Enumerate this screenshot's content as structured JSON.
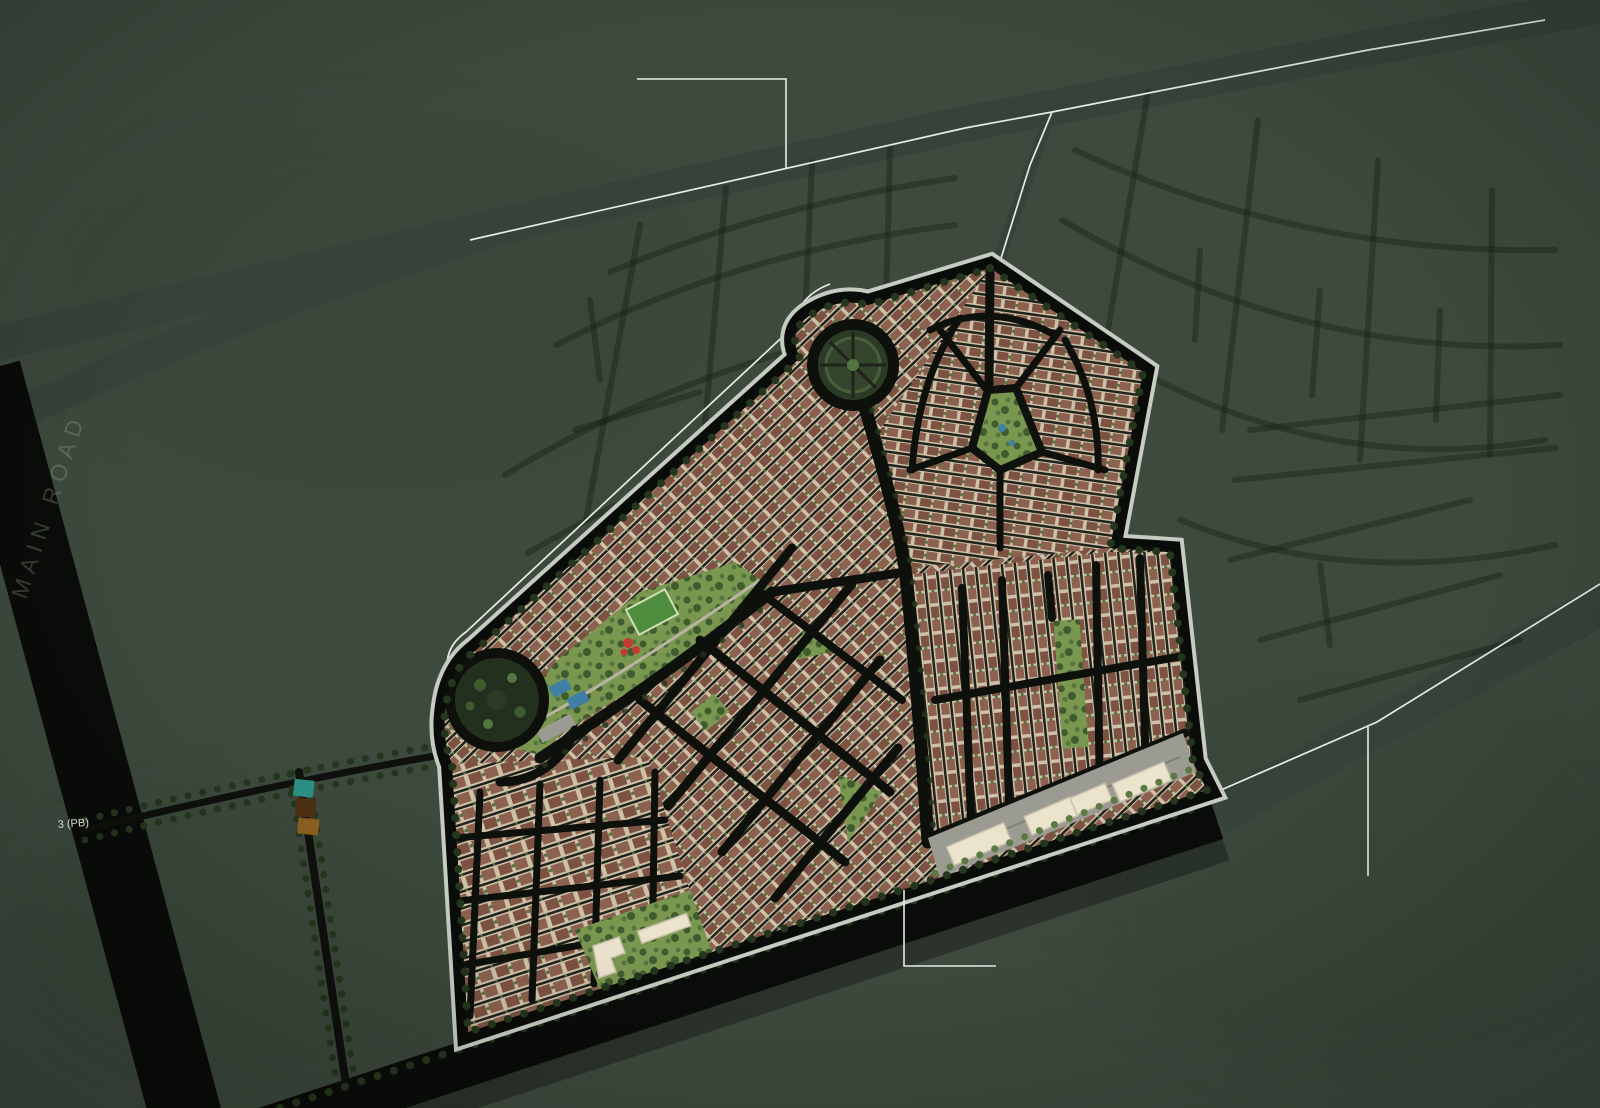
{
  "title": "Residential community masterplan aerial site map",
  "map": {
    "labels": {
      "main_road_vertical": "MAIN ROAD",
      "road_marker": "3 (PB)"
    },
    "legend_swatches": [
      {
        "name": "teal-parcel-swatch",
        "color": "#2a8f82"
      },
      {
        "name": "brown-parcel-swatch",
        "color": "#4a2f12"
      },
      {
        "name": "ochre-parcel-swatch",
        "color": "#8a5e20"
      }
    ],
    "features": {
      "roundabouts": [
        "north-roundabout",
        "west-roundabout"
      ],
      "parks": [
        "linear-park",
        "pentagon-park",
        "east-park-strip",
        "central-triangle-park",
        "community-park"
      ],
      "amenities": [
        "soccer-field",
        "playground",
        "tennis-courts",
        "parking-lot",
        "community-building",
        "apartment-strip"
      ],
      "districts": [
        "pentagon-district",
        "east-district",
        "central-district",
        "southwest-district"
      ],
      "annotations": [
        "callout-top",
        "callout-bottom",
        "callout-right"
      ]
    },
    "colors": {
      "bg": "#3e4a3e",
      "blob": "#384437",
      "faint": "rgba(21,33,19,0.42)",
      "band": "#36433a",
      "white": "#e7ece5",
      "asphalt": "#0e100c",
      "asphaltDeep": "#0a0c09",
      "rim": "#c6ccc2",
      "fabricBase": "#cdc2a8",
      "roofA": "#7d5243",
      "roofB": "#8c6150",
      "street": "#20221b",
      "fleck": "#55743f",
      "park": "#7a9750",
      "parkTree": "#3f5c2f",
      "parkTree2": "#557540",
      "pitch": "#4e8c3e",
      "pitchRim": "#cfe0b5",
      "court": "#3f7fa5",
      "redPlay": "#c23b2e",
      "plaza": "#9b9b93",
      "plazaDark": "#7e8078",
      "cream": "#ece3cd",
      "creamEdge": "#c9c0ab",
      "treeDot": "#24361d",
      "green2": "#5c7b43",
      "walk": "#b9b3a2",
      "roundGreen": "#2c3b26",
      "roundGreen2": "#22301d",
      "roundRing": "#33452a",
      "roundSpoke": "#47603a",
      "label": "rgba(176,196,166,0.27)",
      "marker": "#e6ece4"
    }
  }
}
